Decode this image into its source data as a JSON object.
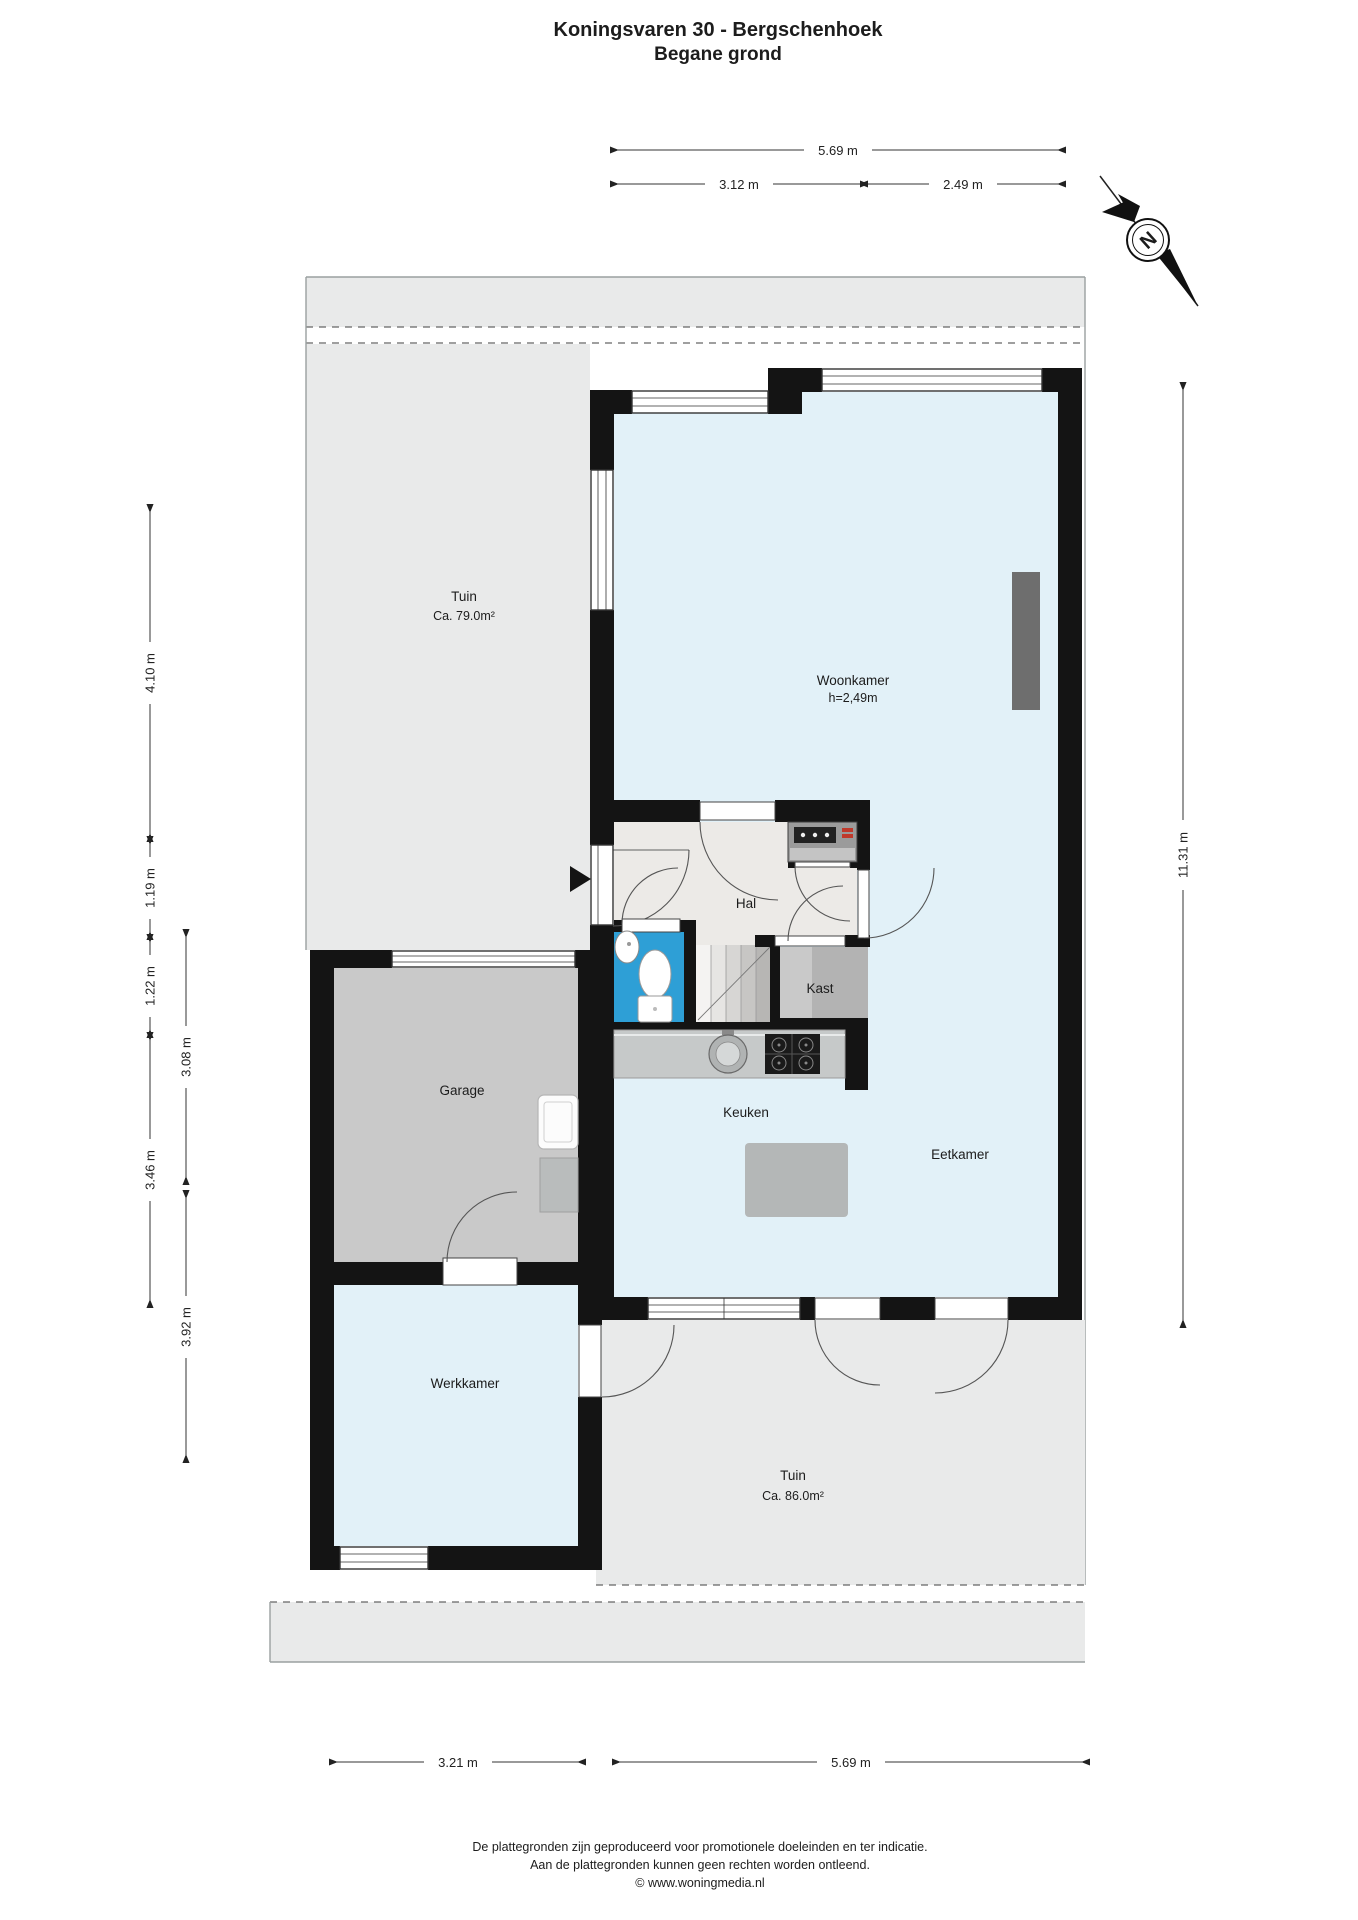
{
  "title": {
    "line1": "Koningsvaren 30 - Bergschenhoek",
    "line2": "Begane grond"
  },
  "plan": {
    "rooms": {
      "tuin_top": {
        "label": "Tuin",
        "area": "Ca. 79.0m²"
      },
      "woonkamer": {
        "label": "Woonkamer",
        "ceiling_height": "h=2,49m"
      },
      "hal": {
        "label": "Hal"
      },
      "kast": {
        "label": "Kast"
      },
      "garage": {
        "label": "Garage"
      },
      "keuken": {
        "label": "Keuken"
      },
      "eetkamer": {
        "label": "Eetkamer"
      },
      "werkkamer": {
        "label": "Werkkamer"
      },
      "tuin_bottom": {
        "label": "Tuin",
        "area": "Ca. 86.0m²"
      }
    },
    "dimensions": {
      "top_total": "5.69 m",
      "top_left": "3.12 m",
      "top_right": "2.49 m",
      "left": [
        "4.10 m",
        "1.19 m",
        "1.22 m",
        "3.46 m",
        "3.08 m",
        "3.92 m"
      ],
      "right": "11.31 m",
      "bottom_left": "3.21 m",
      "bottom_right": "5.69 m"
    },
    "compass_label": "N"
  },
  "footer": {
    "line1": "De plattegronden zijn geproduceerd voor promotionele doeleinden en ter indicatie.",
    "line2": "Aan de plattegronden kunnen geen rechten worden ontleend.",
    "line3": "© www.woningmedia.nl"
  },
  "colors": {
    "wall": "#141414",
    "floor_living": "#e2f1f8",
    "floor_hall": "#eceae7",
    "floor_garage": "#c9c9c9",
    "floor_kast": "#b3b3b3",
    "toilet_blue": "#2e9fd6",
    "garden_gray": "#e9eaea"
  }
}
